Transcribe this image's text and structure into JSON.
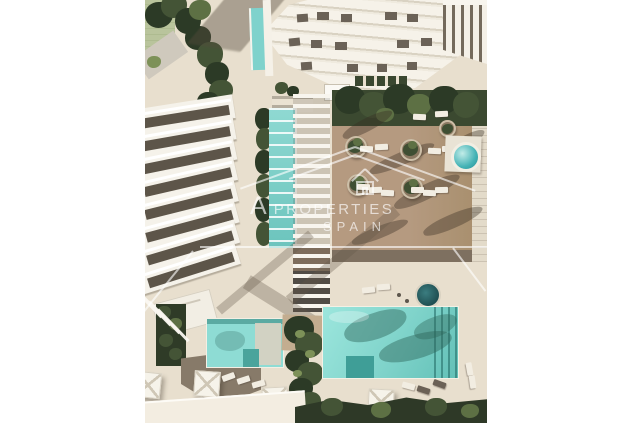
{
  "canvas": {
    "width": 630,
    "height": 423,
    "background": "#ffffff"
  },
  "render": {
    "description": "Aerial top-down 3D architectural rendering of a residential complex: white high-rise tower at top, curved balcony building on the left, central pergola walkway with lap pool, wooden sun deck with loungers and round planters, two turquoise swimming pools at the bottom, palm trees and parasols",
    "left_margin_px": 145,
    "content_width_px": 342
  },
  "watermark": {
    "logo": "house-outline-icon",
    "line1_prefix": "A",
    "line1_word": "PROPERTIES",
    "line2": "SPAIN",
    "color": "#ffffff",
    "opacity": 0.62
  },
  "palette": {
    "plaza": "#e8dfce",
    "deck_wood": "#b59a80",
    "deck_shadow": "#7e7060",
    "pool_water": "#8edcd4",
    "pool_deep": "#55b5ac",
    "jacuzzi": "#35a9ae",
    "hot_tub_dark": "#2e6d70",
    "foliage_dark": "#2c3a26",
    "foliage_mid": "#445436",
    "foliage_light": "#7d9158",
    "lawn": "#b9c49c",
    "building_white": "#f5f2ea",
    "window_dark": "#5d5549",
    "road": "#f3ede1"
  }
}
